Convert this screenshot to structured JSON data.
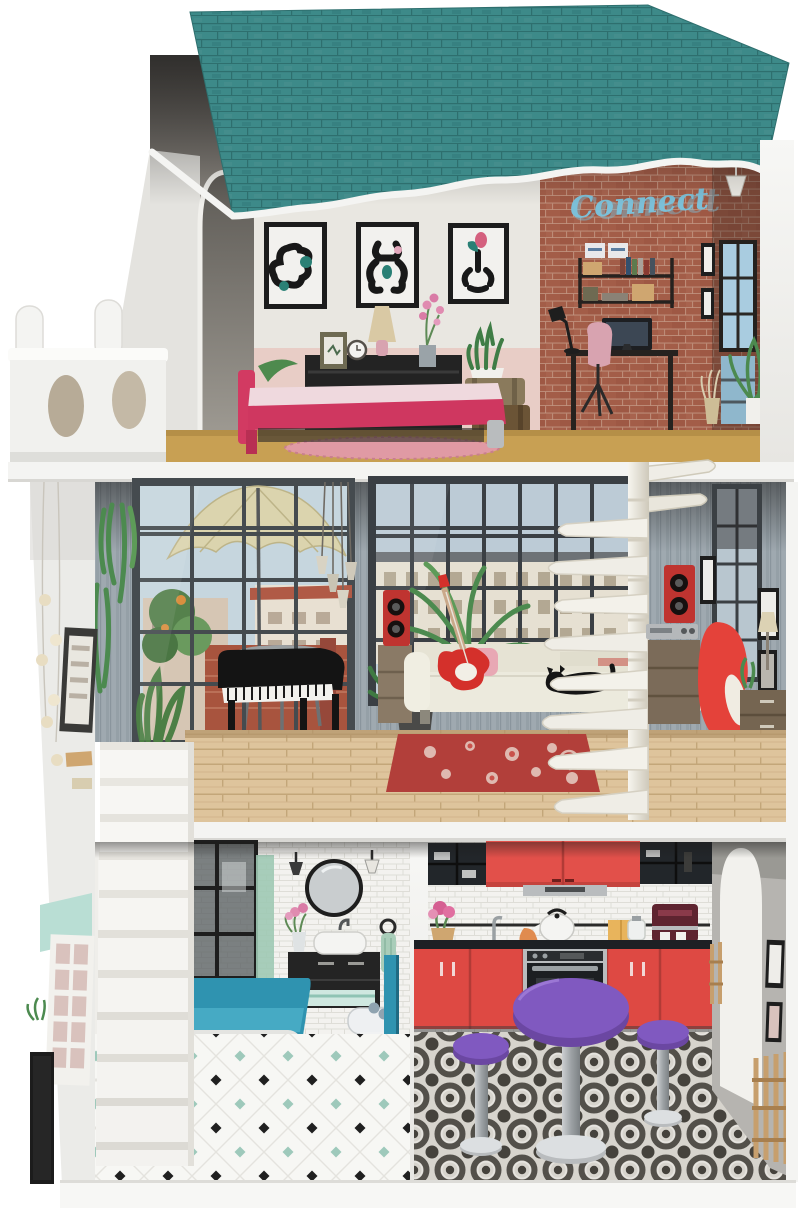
{
  "scene": {
    "type": "product-photo",
    "subject": "three-story wooden dollhouse with furniture, viewed from the open front",
    "background_color": "#ffffff"
  },
  "neon": {
    "text": "Connect",
    "color": "#7cc0d8"
  },
  "palette": {
    "roof_teal": "#3d8a89",
    "trim_white": "#f4f4f2",
    "brick_red": "#a35d48",
    "bedroom_wainscot_pink": "#e8cdc6",
    "bed_pink": "#d23a62",
    "top_floor_wood": "#c8a053",
    "middle_wall_bluegray": "#9fa9b0",
    "middle_floor_wood": "#dec49c",
    "rug_red": "#b23f3a",
    "rug_pink": "#e09aa4",
    "sofa_cream": "#eceadd",
    "guitar_red": "#d4302b",
    "speaker_red": "#bf3430",
    "egg_chair_red": "#e4423a",
    "stair_white": "#f4f3f0",
    "tub_teal": "#2f93b0",
    "kitchen_red": "#e2504a",
    "table_purple": "#7e57b8",
    "mint": "#9ec9bb",
    "kitchen_floor_dark": "#45423c"
  },
  "house": {
    "roof": "teal shingled roof with wavy white front trim",
    "balcony": "white side balcony with oval cutouts and round posts",
    "floors": [
      {
        "name": "top floor",
        "rooms": [
          {
            "name": "bedroom",
            "items": [
              "three abstract wall prints",
              "black dresser",
              "table lamp",
              "alarm clock",
              "photo frame",
              "orchid",
              "snake plant",
              "stacked suitcases",
              "pink double bed",
              "pink oval rug",
              "leafy plant"
            ]
          },
          {
            "name": "home office",
            "wall": "red brick",
            "items": [
              "neon script sign",
              "wall shelf with books and boxes",
              "black desk",
              "computer monitor",
              "desk lamp",
              "pink chair",
              "tall blue window",
              "pendant lamp",
              "palm plant",
              "dried grass vase",
              "small picture frames"
            ]
          }
        ]
      },
      {
        "name": "middle floor",
        "rooms": [
          {
            "name": "music lounge",
            "items": [
              "terrace window with parasol view",
              "hanging plants",
              "pendant light cluster",
              "black grand piano",
              "piano stool",
              "loft window",
              "palm plant",
              "fern in pot",
              "red tower speakers",
              "hi-fi stereo on sideboard",
              "cream sofa",
              "red electric guitar",
              "black cat",
              "red floral rug",
              "white spiral staircase",
              "red egg chair",
              "chest of drawers",
              "tall window",
              "picture frames"
            ]
          }
        ]
      },
      {
        "name": "ground floor",
        "rooms": [
          {
            "name": "bathroom",
            "items": [
              "white staircase",
              "dark shower screen",
              "round mirror",
              "wall sconces",
              "black vanity with white basin",
              "flower vase",
              "towel ring",
              "teal bathtub",
              "bidet",
              "diamond tile floor"
            ]
          },
          {
            "name": "kitchen",
            "items": [
              "glass display cabinets",
              "red wall cupboards",
              "extractor hood",
              "utensil rail",
              "white kettle",
              "coffee machine",
              "flower pot",
              "oven",
              "red base cabinets",
              "purple pedestal table",
              "two purple stools",
              "ornate patterned tile floor",
              "arched doorway",
              "wooden chairs"
            ]
          }
        ]
      }
    ]
  }
}
